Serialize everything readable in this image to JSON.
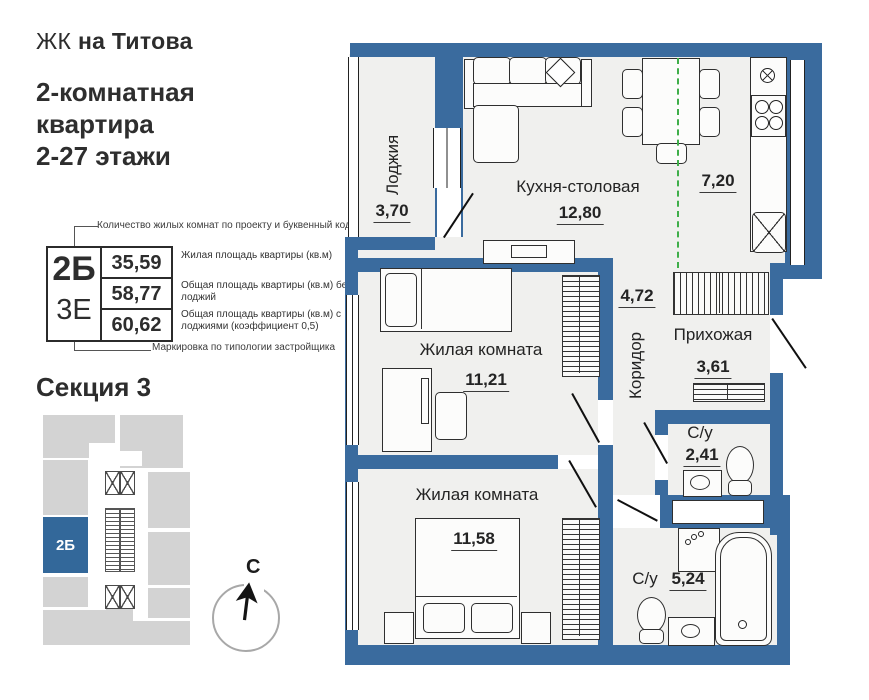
{
  "header": {
    "brand_thin": "ЖК",
    "brand_bold": "на Титова",
    "title1": "2-комнатная",
    "title2": "квартира",
    "title3": "2-27 этажи"
  },
  "legend": {
    "top_note": "Количество жилых комнат по проекту и буквенный код",
    "bottom_note": "Маркировка по типологии застройщика",
    "code_primary": "2Б",
    "code_secondary": "3Е",
    "rows": [
      {
        "value": "35,59",
        "label": "Жилая площадь квартиры (кв.м)"
      },
      {
        "value": "58,77",
        "label": "Общая площадь квартиры (кв.м) без лоджий"
      },
      {
        "value": "60,62",
        "label": "Общая площадь квартиры (кв.м) с лоджиями (коэффициент 0,5)"
      }
    ]
  },
  "section": {
    "title": "Секция 3",
    "unit": "2Б"
  },
  "compass": {
    "north": "С"
  },
  "plan": {
    "loggia": {
      "name": "Лоджия",
      "area": "3,70"
    },
    "kitchen": {
      "name": "Кухня-столовая",
      "area": "12,80"
    },
    "kitchen_zone": {
      "area": "7,20"
    },
    "corridor": {
      "name": "Коридор",
      "area": "4,72"
    },
    "hallway": {
      "name": "Прихожая",
      "area": "3,61"
    },
    "room1": {
      "name": "Жилая комната",
      "area": "11,21"
    },
    "room2": {
      "name": "Жилая комната",
      "area": "11,58"
    },
    "bath1": {
      "name": "С/у",
      "area": "2,41"
    },
    "bath2": {
      "name": "С/у",
      "area": "5,24"
    }
  },
  "colors": {
    "wall": "#3a6b9e",
    "room_fill": "#f0f0ee",
    "kitchen_zone_line": "#3fae49",
    "unit_highlight": "#33689a",
    "block_gray": "#d3d3d3"
  }
}
